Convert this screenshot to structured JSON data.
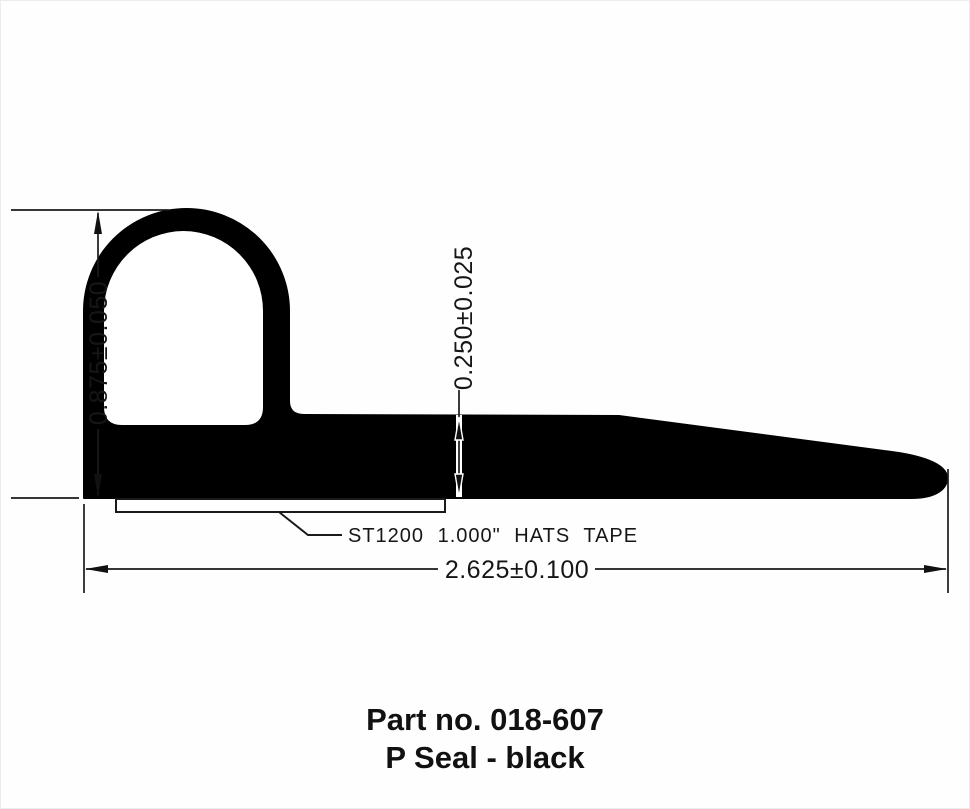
{
  "drawing": {
    "title": "P seal cross-section technical drawing",
    "dimensions": {
      "height_label": "0.875±0.050",
      "thickness_label": "0.250±0.025",
      "width_label": "2.625±0.100"
    },
    "tape_label": "ST1200 1.000\" HATS TAPE",
    "colors": {
      "seal_fill": "#000000",
      "line": "#1a1a1a",
      "background": "#fefefe"
    }
  },
  "caption": {
    "part_no": "Part no. 018-607",
    "description": "P Seal - black"
  }
}
